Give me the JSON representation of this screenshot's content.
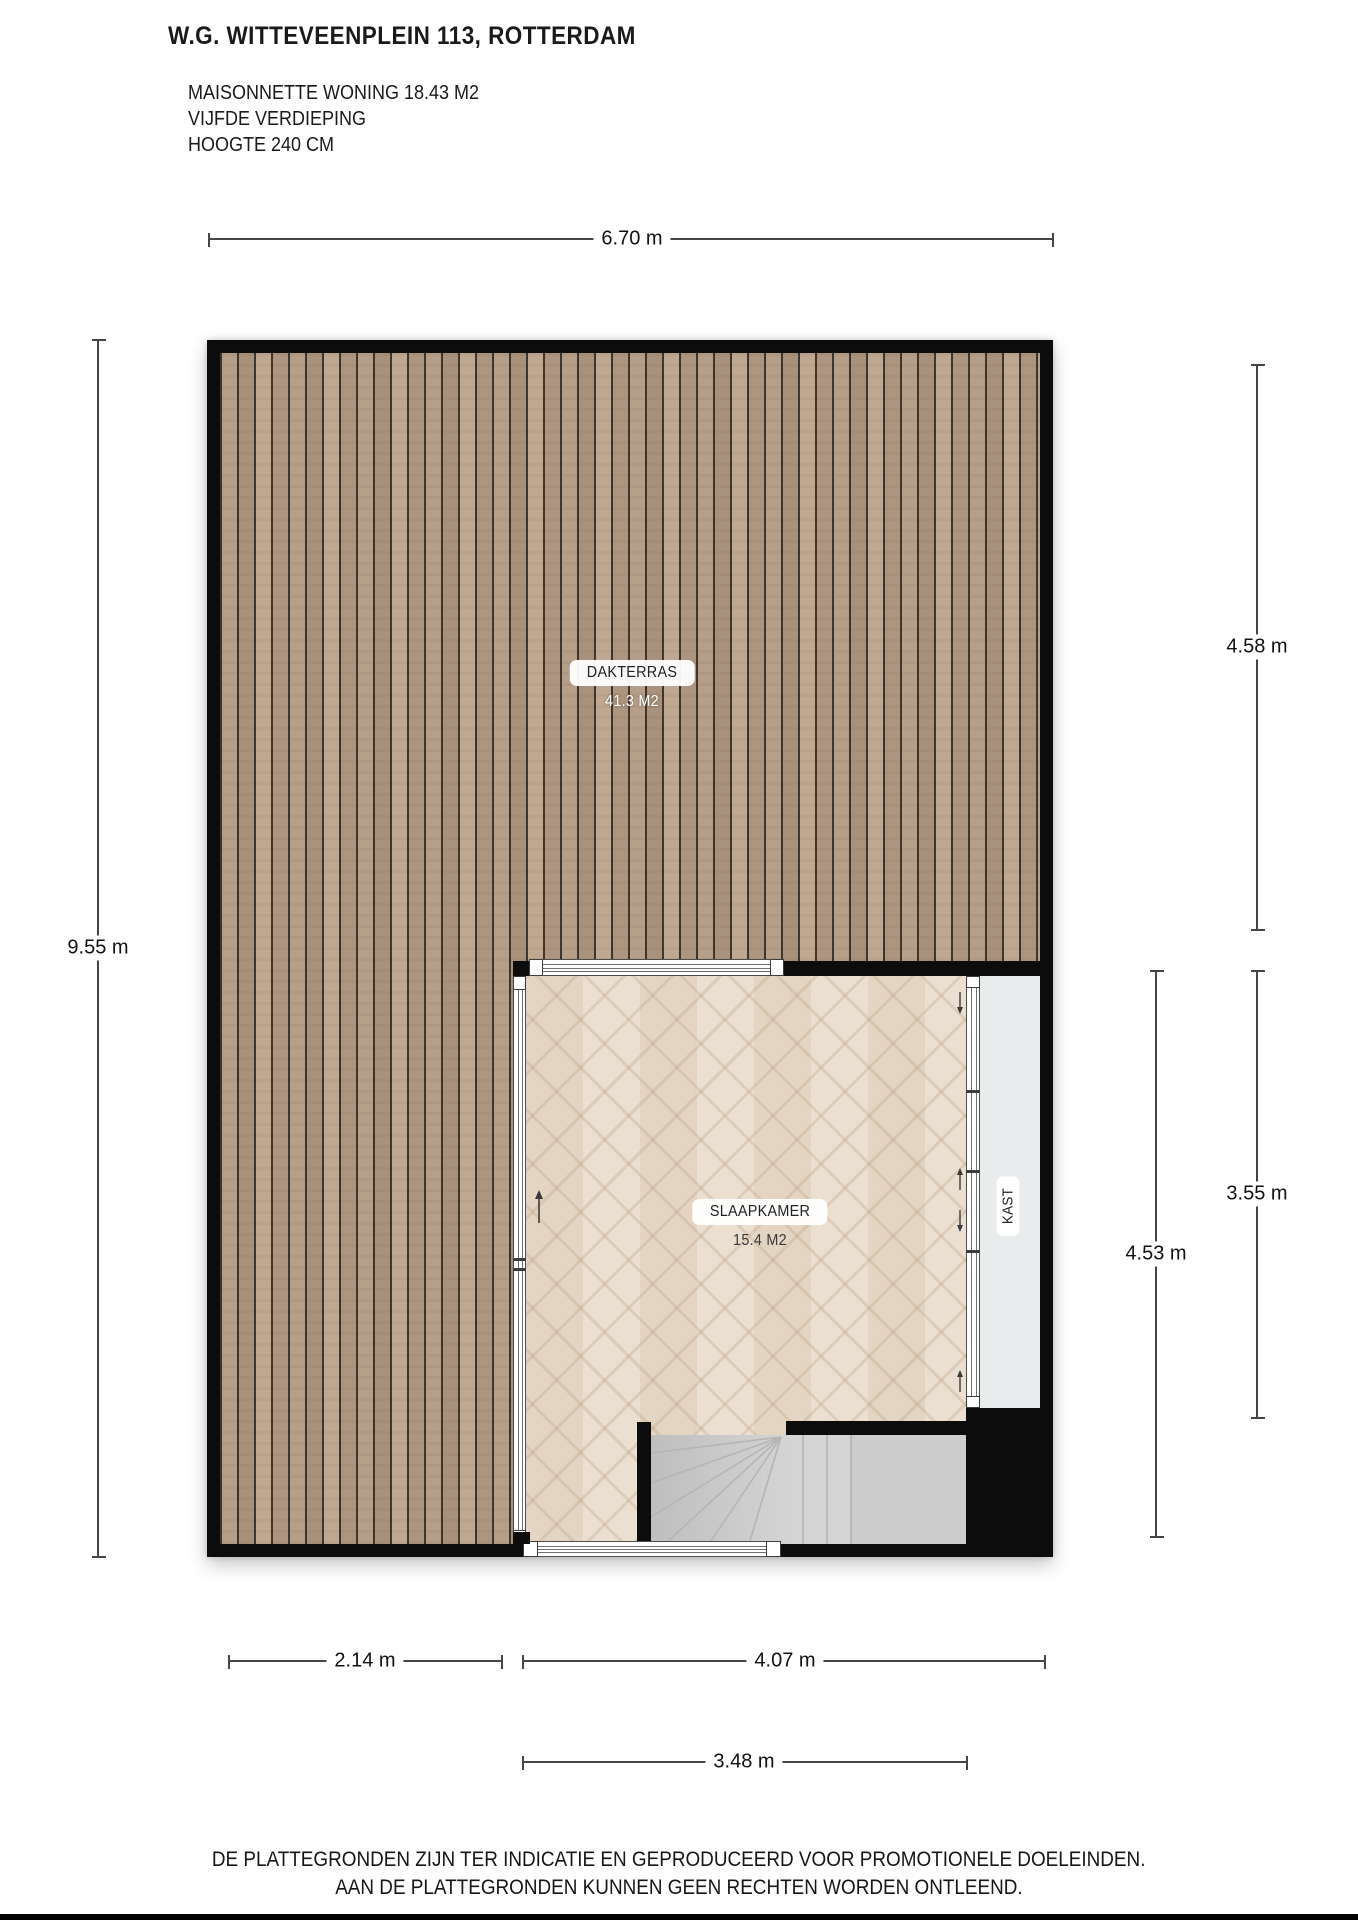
{
  "header": {
    "title": "W.G. WITTEVEENPLEIN 113, ROTTERDAM",
    "subtitle": [
      "MAISONNETTE WONING 18.43 M2",
      "VIJFDE VERDIEPING",
      "HOOGTE 240 CM"
    ]
  },
  "rooms": {
    "dakterras": {
      "label": "DAKTERRAS",
      "area": "41.3 M2"
    },
    "slaapkamer": {
      "label": "SLAAPKAMER",
      "area": "15.4 M2"
    },
    "kast": {
      "label": "KAST"
    }
  },
  "dimensions": {
    "top": {
      "label": "6.70 m"
    },
    "left": {
      "label": "9.55 m"
    },
    "right_terrace": {
      "label": "4.58 m"
    },
    "right_room": {
      "label": "3.55 m"
    },
    "right_total": {
      "label": "4.53 m"
    },
    "bottom_terrace": {
      "label": "2.14 m"
    },
    "bottom_room": {
      "label": "4.07 m"
    },
    "bottom_inner": {
      "label": "3.48 m"
    }
  },
  "footer": {
    "line1": "DE PLATTEGRONDEN ZIJN TER INDICATIE EN GEPRODUCEERD VOOR PROMOTIONELE DOELEINDEN.",
    "line2": "AAN DE PLATTEGRONDEN KUNNEN GEEN RECHTEN WORDEN ONTLEEND."
  },
  "colors": {
    "wall": "#0c0c0c",
    "decking": "#b29a84",
    "parquet": "#eadfd0",
    "stairs": "#d4d4d4",
    "closet_interior": "#e8ecec",
    "dimension_line": "#454545"
  }
}
